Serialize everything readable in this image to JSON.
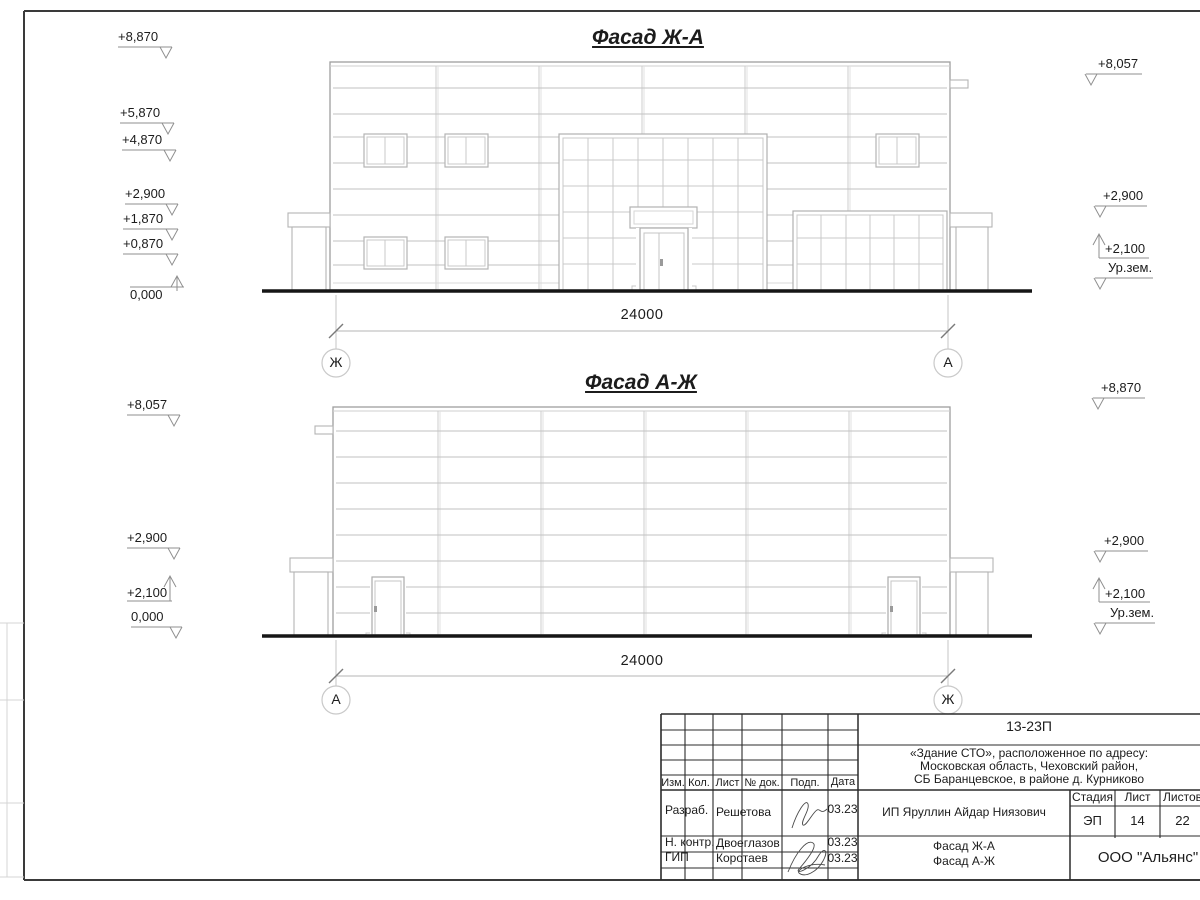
{
  "sheet": {
    "facade_top": {
      "title": "Фасад Ж-А",
      "dimension": "24000",
      "axis_left": "Ж",
      "axis_right": "А",
      "marks_left": [
        {
          "text": "+8,870",
          "dir": "down"
        },
        {
          "text": "+5,870",
          "dir": "down"
        },
        {
          "text": "+4,870",
          "dir": "down"
        },
        {
          "text": "+2,900",
          "dir": "down"
        },
        {
          "text": "+1,870",
          "dir": "down"
        },
        {
          "text": "+0,870",
          "dir": "down"
        },
        {
          "text": "0,000",
          "dir": "up"
        }
      ],
      "marks_right": [
        {
          "text": "+8,057",
          "dir": "down"
        },
        {
          "text": "+2,900",
          "dir": "down"
        },
        {
          "text": "+2,100",
          "dir": "up"
        },
        {
          "text": "Ур.зем.",
          "dir": "down"
        }
      ]
    },
    "facade_bottom": {
      "title": "Фасад А-Ж",
      "dimension": "24000",
      "axis_left": "А",
      "axis_right": "Ж",
      "marks_left": [
        {
          "text": "+8,057",
          "dir": "down"
        },
        {
          "text": "+2,900",
          "dir": "down"
        },
        {
          "text": "+2,100",
          "dir": "up"
        },
        {
          "text": "0,000",
          "dir": "down"
        }
      ],
      "marks_right": [
        {
          "text": "+8,870",
          "dir": "down"
        },
        {
          "text": "+2,900",
          "dir": "down"
        },
        {
          "text": "+2,100",
          "dir": "up"
        },
        {
          "text": "Ур.зем.",
          "dir": "down"
        }
      ]
    },
    "title_block": {
      "doc_number": "13-23П",
      "address_lines": [
        "«Здание СТО», расположенное по адресу:",
        "Московская область, Чеховский район,",
        "СБ Баранцевское, в районе д. Курниково"
      ],
      "columns": [
        "Изм.",
        "Кол.",
        "Лист",
        "№ док.",
        "Подп.",
        "Дата"
      ],
      "signature_rows": [
        {
          "role": "Разраб.",
          "name": "Решетова",
          "date": "03.23"
        },
        {
          "role": "Н. контр.",
          "name": "Двоеглазов",
          "date": "03.23"
        },
        {
          "role": "ГИП",
          "name": "Коротаев",
          "date": "03.23"
        }
      ],
      "client": "ИП Яруллин Айдар Ниязович",
      "stage_label": "Стадия",
      "sheet_label": "Лист",
      "sheets_label": "Листов",
      "stage": "ЭП",
      "sheet_number": "14",
      "sheets_total": "22",
      "sheet_title_lines": [
        "Фасад Ж-А",
        "Фасад А-Ж"
      ],
      "organization": "ООО \"Альянс\""
    },
    "colors": {
      "line_light": "#c2c2c2",
      "line_dark": "#2b2b2b",
      "ground": "#161616"
    }
  }
}
